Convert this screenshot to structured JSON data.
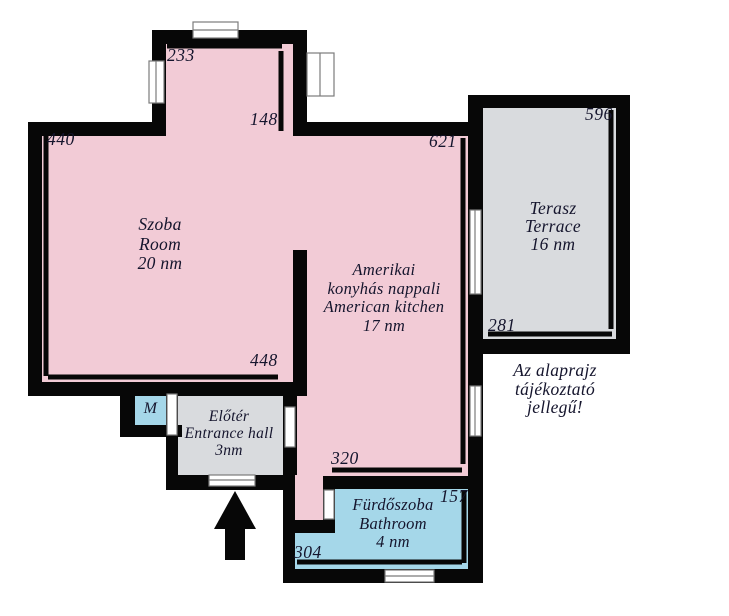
{
  "rooms": {
    "szoba": {
      "name_hu": "Szoba",
      "name_en": "Room",
      "area": "20 nm"
    },
    "nappali": {
      "name_line1": "Amerikai",
      "name_line2": "konyhás nappali",
      "name_en": "American kitchen",
      "area": "17 nm"
    },
    "terasz": {
      "name_hu": "Terasz",
      "name_en": "Terrace",
      "area": "16 nm"
    },
    "eloter": {
      "name_hu": "Előtér",
      "name_en": "Entrance hall",
      "area": "3nm"
    },
    "furdoszoba": {
      "name_hu": "Fürdőszoba",
      "name_en": "Bathroom",
      "area": "4 nm"
    },
    "m_box": {
      "label": "M"
    }
  },
  "dimensions_cm": {
    "szoba_left": "440",
    "szoba_bottom": "448",
    "nook_top": "233",
    "nook_right": "148",
    "nappali_right": "621",
    "nappali_bottom": "320",
    "terasz_right": "596",
    "terasz_bottom": "281",
    "furdo_right": "157",
    "furdo_bottom": "304"
  },
  "disclaimer": {
    "line1": "Az alaprajz",
    "line2": "tájékoztató",
    "line3": "jellegű!"
  },
  "colors": {
    "room_fill": "#f2cbd6",
    "terrace_fill": "#d9dbde",
    "wet_fill": "#a5d7e9",
    "wall": "#070707",
    "ink": "#15152d",
    "window_frame": "#7b7b7b"
  }
}
